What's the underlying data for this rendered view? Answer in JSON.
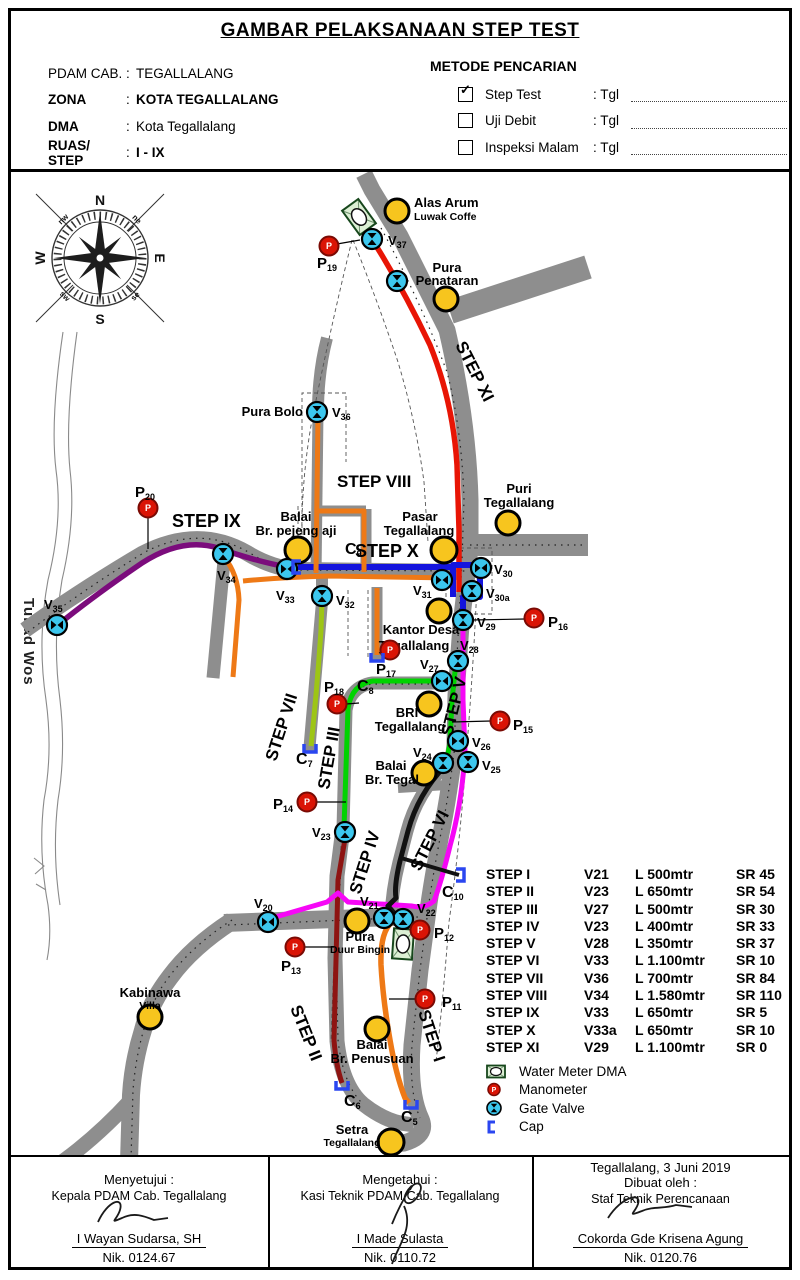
{
  "colors": {
    "road": "#8e8e8e",
    "pipe_red": "#e81505",
    "pipe_purple": "#7b0c7c",
    "pipe_blue": "#1414dd",
    "pipe_orange": "#ee7916",
    "pipe_magenta": "#f607f6",
    "pipe_green": "#00d300",
    "pipe_olive": "#9dc515",
    "pipe_darkred": "#8e1412",
    "pipe_black": "#111111",
    "valve_cyan": "#3cc7ee",
    "manometer_red": "#da1405",
    "poi_yellow": "#f7c51e",
    "watermeter_green": "#dcefd4",
    "cap_blue": "#2a46f0"
  },
  "header": {
    "title": "GAMBAR PELAKSANAAN STEP TEST",
    "colon": ":",
    "fields": [
      {
        "label": "PDAM CAB.",
        "value": "TEGALLALANG"
      },
      {
        "label": "ZONA",
        "value": "KOTA TEGALLALANG"
      },
      {
        "label": "DMA",
        "value": "Kota Tegallalang"
      },
      {
        "label": "RUAS/ STEP",
        "value": "I - IX"
      }
    ],
    "metode": {
      "title": "METODE PENCARIAN",
      "rows": [
        {
          "label": "Step Test",
          "mark": "✓",
          "tgl": ": Tgl"
        },
        {
          "label": "Uji Debit",
          "mark": "",
          "tgl": ": Tgl"
        },
        {
          "label": "Inspeksi Malam",
          "mark": "",
          "tgl": ": Tgl"
        }
      ]
    }
  },
  "map": {
    "compass": {
      "n": "N",
      "e": "E",
      "s": "S",
      "w": "W",
      "ne": "ne",
      "nw": "nw",
      "se": "se",
      "sw": "sw"
    },
    "river": "Tukad Wos",
    "mano_glyph": "P",
    "steps": [
      {
        "text": "STEP XI"
      },
      {
        "text": "STEP X"
      },
      {
        "text": "STEP VIII"
      },
      {
        "text": "STEP IX"
      },
      {
        "text": "STEP VII"
      },
      {
        "text": "STEP III"
      },
      {
        "text": "STEP V"
      },
      {
        "text": "STEP IV"
      },
      {
        "text": "STEP VI"
      },
      {
        "text": "STEP II"
      },
      {
        "text": "STEP I"
      }
    ],
    "pois": [
      {
        "l1": "Alas Arum",
        "l2": "Luwak Coffe"
      },
      {
        "l1": "Pura",
        "l2": "Penataran"
      },
      {
        "l1": "Pura Bolo",
        "l2": ""
      },
      {
        "l1": "Puri",
        "l2": "Tegallalang"
      },
      {
        "l1": "Pasar",
        "l2": "Tegallalang"
      },
      {
        "l1": "Balai",
        "l2": "Br. pejeng aji"
      },
      {
        "l1": "Kantor Desa",
        "l2": "Tegallalang"
      },
      {
        "l1": "BRI",
        "l2": "Tegallalang"
      },
      {
        "l1": "Balai",
        "l2": "Br. Tegal"
      },
      {
        "l1": "Pura",
        "l2": "Duur Bingin"
      },
      {
        "l1": "Kabinawa",
        "l2": "Villa"
      },
      {
        "l1": "Balai",
        "l2": "Br. Penusuan"
      },
      {
        "l1": "Setra",
        "l2": "Tegallalang"
      }
    ],
    "valves": [
      {
        "p": "V",
        "s": "37"
      },
      {
        "p": "V",
        "s": "36"
      },
      {
        "p": "V",
        "s": "35"
      },
      {
        "p": "V",
        "s": "34"
      },
      {
        "p": "V",
        "s": "33"
      },
      {
        "p": "V",
        "s": "32"
      },
      {
        "p": "V",
        "s": "31"
      },
      {
        "p": "V",
        "s": "30"
      },
      {
        "p": "V",
        "s": "30a"
      },
      {
        "p": "V",
        "s": "29"
      },
      {
        "p": "V",
        "s": "28"
      },
      {
        "p": "V",
        "s": "27"
      },
      {
        "p": "V",
        "s": "26"
      },
      {
        "p": "V",
        "s": "25"
      },
      {
        "p": "V",
        "s": "24"
      },
      {
        "p": "V",
        "s": "23"
      },
      {
        "p": "V",
        "s": "22"
      },
      {
        "p": "V",
        "s": "21"
      },
      {
        "p": "V",
        "s": "20"
      }
    ],
    "manometers": [
      {
        "p": "P",
        "s": "19"
      },
      {
        "p": "P",
        "s": "20"
      },
      {
        "p": "P",
        "s": "18"
      },
      {
        "p": "P",
        "s": "17"
      },
      {
        "p": "P",
        "s": "16"
      },
      {
        "p": "P",
        "s": "15"
      },
      {
        "p": "P",
        "s": "14"
      },
      {
        "p": "P",
        "s": "13"
      },
      {
        "p": "P",
        "s": "12"
      },
      {
        "p": "P",
        "s": "11"
      }
    ],
    "caps": [
      {
        "p": "C",
        "s": "9"
      },
      {
        "p": "C",
        "s": "8"
      },
      {
        "p": "C",
        "s": "7"
      },
      {
        "p": "C",
        "s": "10"
      },
      {
        "p": "C",
        "s": "6"
      },
      {
        "p": "C",
        "s": "5"
      }
    ]
  },
  "table": {
    "rows": [
      {
        "step": "STEP I",
        "valve": "V21",
        "len": "L 500mtr",
        "sr": "SR 45"
      },
      {
        "step": "STEP II",
        "valve": "V23",
        "len": "L 650mtr",
        "sr": "SR 54"
      },
      {
        "step": "STEP III",
        "valve": "V27",
        "len": "L 500mtr",
        "sr": "SR 30"
      },
      {
        "step": "STEP IV",
        "valve": "V23",
        "len": "L 400mtr",
        "sr": "SR 33"
      },
      {
        "step": "STEP V",
        "valve": "V28",
        "len": "L 350mtr",
        "sr": "SR 37"
      },
      {
        "step": "STEP VI",
        "valve": "V33",
        "len": "L 1.100mtr",
        "sr": "SR 10"
      },
      {
        "step": "STEP VII",
        "valve": "V36",
        "len": "L 700mtr",
        "sr": "SR 84"
      },
      {
        "step": "STEP VIII",
        "valve": "V34",
        "len": "L 1.580mtr",
        "sr": "SR 110"
      },
      {
        "step": "STEP IX",
        "valve": "V33",
        "len": "L 650mtr",
        "sr": "SR 5"
      },
      {
        "step": "STEP X",
        "valve": "V33a",
        "len": "L 650mtr",
        "sr": "SR 10"
      },
      {
        "step": "STEP XI",
        "valve": "V29",
        "len": "L 1.100mtr",
        "sr": "SR 0"
      }
    ]
  },
  "legend": {
    "items": [
      {
        "label": "Water Meter DMA"
      },
      {
        "label": "Manometer"
      },
      {
        "label": "Gate Valve"
      },
      {
        "label": "Cap"
      }
    ]
  },
  "footer": {
    "left": {
      "l1": "Menyetujui :",
      "l2": "Kepala PDAM Cab. Tegallalang",
      "name": "I Wayan Sudarsa, SH",
      "nik": "Nik. 0124.67"
    },
    "mid": {
      "l1": "Mengetahui :",
      "l2": "Kasi Teknik PDAM Cab. Tegallalang",
      "name": "I Made Sulasta",
      "nik": "Nik. 0110.72"
    },
    "right": {
      "date": "Tegallalang,  3 Juni 2019",
      "l1": "Dibuat oleh :",
      "l2": "Staf Teknik Perencanaan",
      "name": "Cokorda Gde Krisena Agung",
      "nik": "Nik. 0120.76"
    }
  }
}
